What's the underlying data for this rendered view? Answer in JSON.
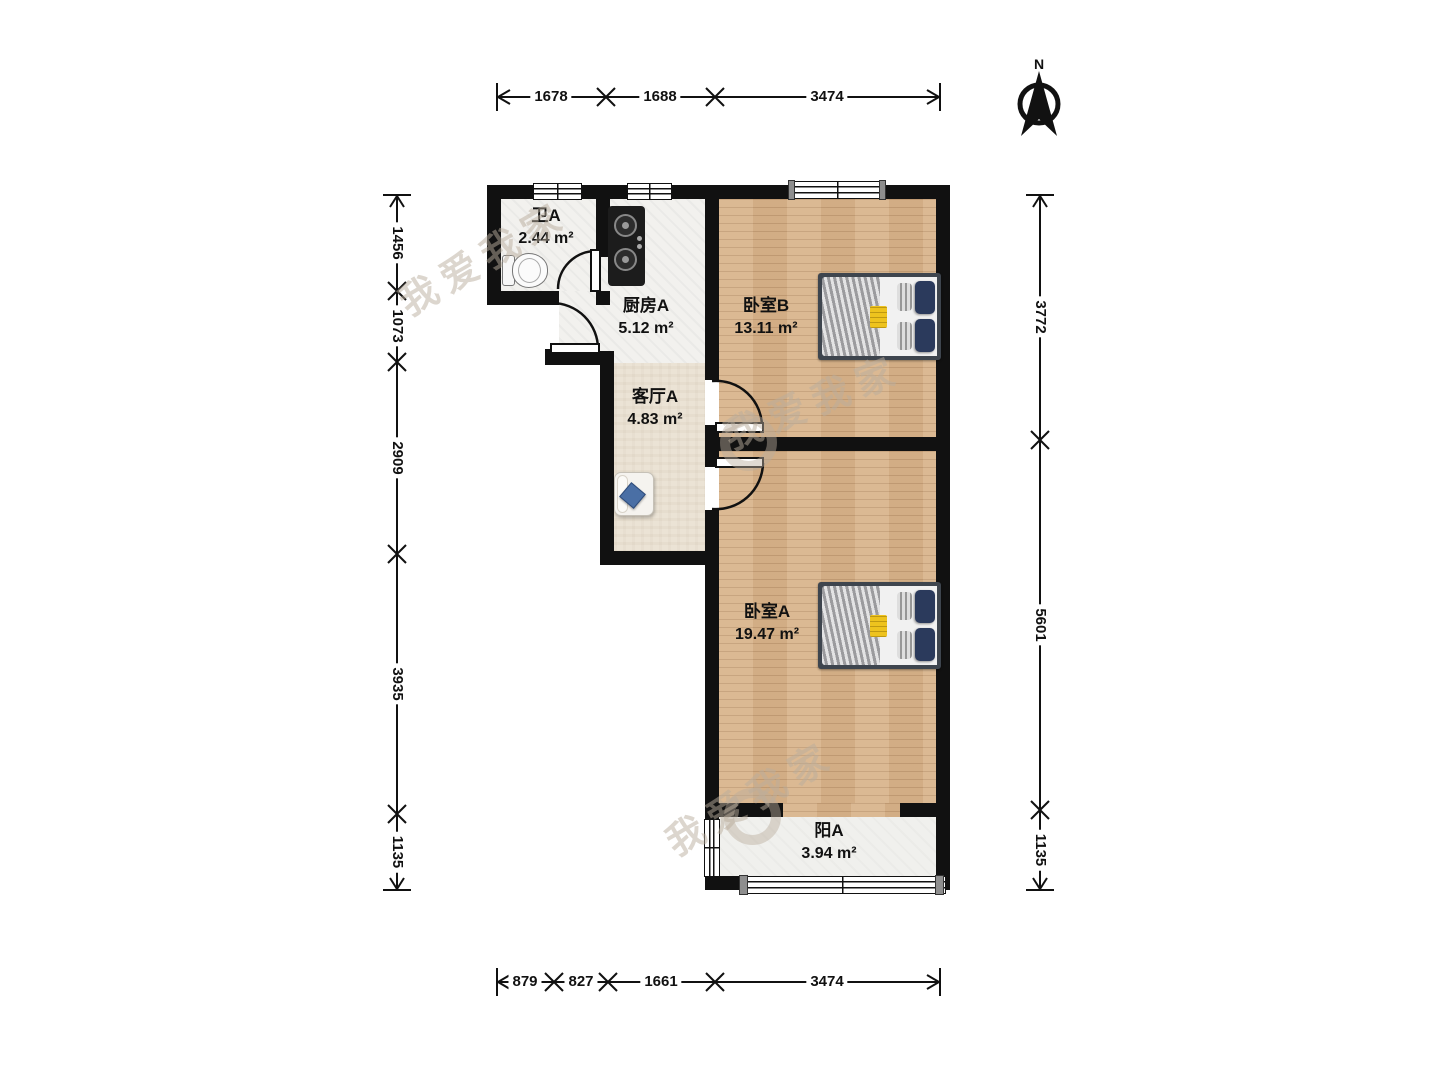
{
  "title": "两室一厅户型图",
  "compass": {
    "north_label": "N"
  },
  "rooms": {
    "bathroom": {
      "name": "卫A",
      "area": "2.44 m²"
    },
    "kitchen": {
      "name": "厨房A",
      "area": "5.12 m²"
    },
    "living": {
      "name": "客厅A",
      "area": "4.83 m²"
    },
    "bedroom_b": {
      "name": "卧室B",
      "area": "13.11 m²"
    },
    "bedroom_a": {
      "name": "卧室A",
      "area": "19.47 m²"
    },
    "balcony": {
      "name": "阳A",
      "area": "3.94 m²"
    }
  },
  "fixtures": {
    "bathroom": "toilet",
    "kitchen": "gas-stove",
    "living": "sofa",
    "bedroom_b": "double-bed",
    "bedroom_a": "double-bed"
  },
  "dimensions_mm": {
    "top": [
      "1678",
      "1688",
      "3474"
    ],
    "bottom": [
      "879",
      "827",
      "1661",
      "3474"
    ],
    "left": [
      "1456",
      "1073",
      "2909",
      "3935",
      "1135"
    ],
    "right": [
      "3772",
      "5601",
      "1135"
    ]
  },
  "watermark": {
    "text": "我爱我家"
  },
  "colors": {
    "wall": "#111111",
    "wood_floor": "#d9b58c",
    "tile_floor": "#f2f1ee",
    "living_floor": "#ebe3d5",
    "balcony_floor": "#f0f0ed",
    "pillow_navy": "#2b3a5c",
    "accent_yellow": "#eec31e",
    "sofa_pillow_blue": "#4a6fa5",
    "watermark_gray": "#beae9e"
  }
}
